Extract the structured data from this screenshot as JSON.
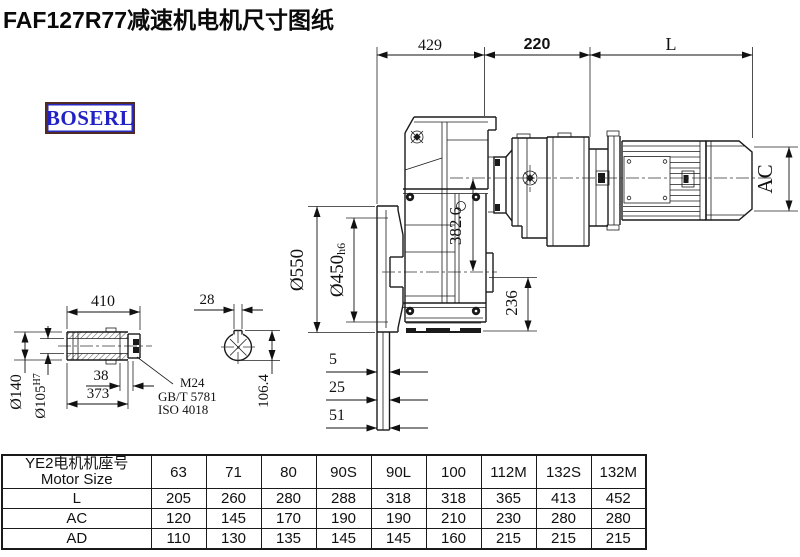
{
  "title": "FAF127R77减速机电机尺寸图纸",
  "logo": {
    "text": "BOSERL"
  },
  "drawing": {
    "dims": {
      "span_429": "429",
      "span_220": "220",
      "span_L": "L",
      "motor_od_AC": "AC",
      "flange_od": "Ø550",
      "spigot_d": "Ø450",
      "spigot_tol": "h6",
      "height_3826": "382.6",
      "foot_236": "236",
      "flange_5": "5",
      "flange_25": "25",
      "flange_51": "51",
      "shaft_410": "410",
      "hub_od": "Ø140",
      "bore_d": "Ø105",
      "bore_tol": "H7",
      "cap_38": "38",
      "len_373": "373",
      "key_28": "28",
      "key_1064": "106.4",
      "bolt_m24": "M24",
      "std_gb": "GB/T 5781",
      "std_iso": "ISO 4018"
    }
  },
  "table": {
    "header_cn": "YE2电机机座号",
    "header_en": "Motor Size",
    "columns": [
      "63",
      "71",
      "80",
      "90S",
      "90L",
      "100",
      "112M",
      "132S",
      "132M"
    ],
    "rows": [
      {
        "label": "L",
        "values": [
          "205",
          "260",
          "280",
          "288",
          "318",
          "318",
          "365",
          "413",
          "452"
        ]
      },
      {
        "label": "AC",
        "values": [
          "120",
          "145",
          "170",
          "190",
          "190",
          "210",
          "230",
          "280",
          "280"
        ]
      },
      {
        "label": "AD",
        "values": [
          "110",
          "130",
          "135",
          "145",
          "145",
          "160",
          "215",
          "215",
          "215"
        ]
      }
    ]
  },
  "colors": {
    "line": "#1a1a1a",
    "logo_text": "#2121c6",
    "logo_border": "#4f2b23"
  }
}
